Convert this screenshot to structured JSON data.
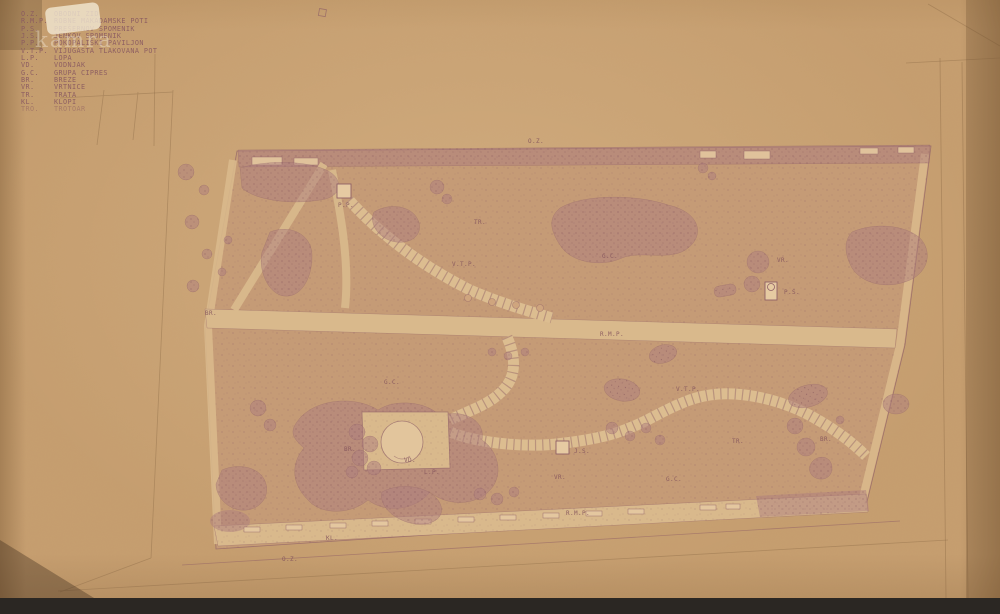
{
  "watermark": {
    "text": "kamra"
  },
  "legend": {
    "items": [
      {
        "abbr": "O.Z.",
        "label": "OBODNI ZID"
      },
      {
        "abbr": "R.M.P.",
        "label": "ROBNE MAKADAMSKE POTI"
      },
      {
        "abbr": "P.S.",
        "label": "PREŠERNOV SPOMENIK"
      },
      {
        "abbr": "J.S.",
        "label": "JENKOV SPOMENIK"
      },
      {
        "abbr": "P.P.",
        "label": "POKOPALIŠKI PAVILJON"
      },
      {
        "abbr": "V.T.P.",
        "label": "VIJUGASTA TLAKOVANA POT"
      },
      {
        "abbr": "L.P.",
        "label": "LOPA"
      },
      {
        "abbr": "VD.",
        "label": "VODNJAK"
      },
      {
        "abbr": "G.C.",
        "label": "GRUPA CIPRES"
      },
      {
        "abbr": "BR.",
        "label": "BREZE"
      },
      {
        "abbr": "VR.",
        "label": "VRTNICE"
      },
      {
        "abbr": "TR.",
        "label": "TRATA"
      },
      {
        "abbr": "KL.",
        "label": "KLOPI"
      },
      {
        "abbr": "TRO.",
        "label": "TROTOAR"
      }
    ]
  },
  "plan": {
    "labels": [
      {
        "text": "O.Z."
      },
      {
        "text": "TR."
      },
      {
        "text": "G.C."
      },
      {
        "text": "VR."
      },
      {
        "text": "P.S."
      },
      {
        "text": "V.T.P."
      },
      {
        "text": "P.P."
      },
      {
        "text": "R.M.P."
      },
      {
        "text": "BR."
      },
      {
        "text": "G.C."
      },
      {
        "text": "V.T.P."
      },
      {
        "text": "TR."
      },
      {
        "text": "BR."
      },
      {
        "text": "BR."
      },
      {
        "text": "VD."
      },
      {
        "text": "L.P."
      },
      {
        "text": "J.S."
      },
      {
        "text": "VR."
      },
      {
        "text": "G.C."
      },
      {
        "text": "R.M.P."
      },
      {
        "text": "KL."
      },
      {
        "text": "O.Z."
      }
    ]
  },
  "colors": {
    "paper": "#c69e6f",
    "ink": "#8f5f66",
    "shrub": "#ad7d7d",
    "walk": "#d9b98c",
    "scan_background": "#2b2723"
  }
}
